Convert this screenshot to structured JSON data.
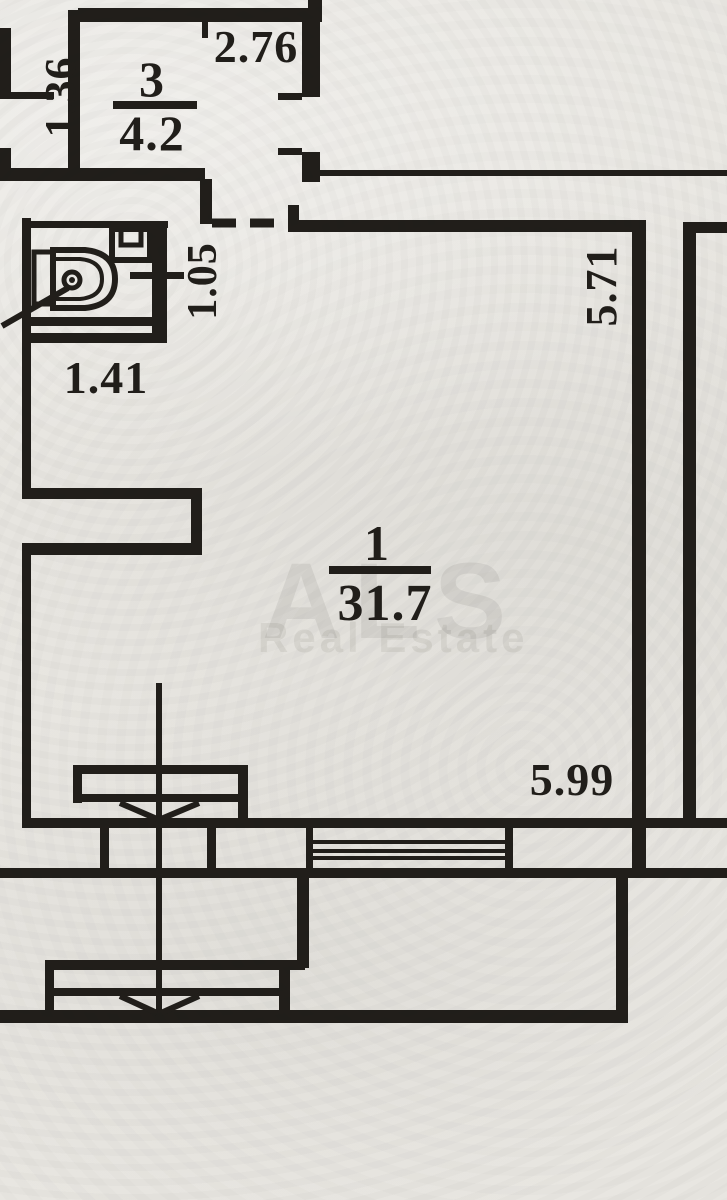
{
  "document": {
    "kind": "apartment-floor-plan-photo"
  },
  "watermark": {
    "brand": "ALS",
    "subtitle": "Real Estate"
  },
  "rooms": [
    {
      "number": "3",
      "area": "4.2"
    },
    {
      "number": "1",
      "area": "31.7"
    }
  ],
  "dimensions": {
    "shaft_width": "1.36",
    "room3_width": "2.76",
    "bathroom_depth": "1.05",
    "hall_width": "1.41",
    "room1_depth": "5.71",
    "room1_width": "5.99"
  },
  "colors": {
    "paper": "#e8e6e1",
    "ink": "#211e1a",
    "watermark": "rgba(40,38,32,0.08)"
  }
}
